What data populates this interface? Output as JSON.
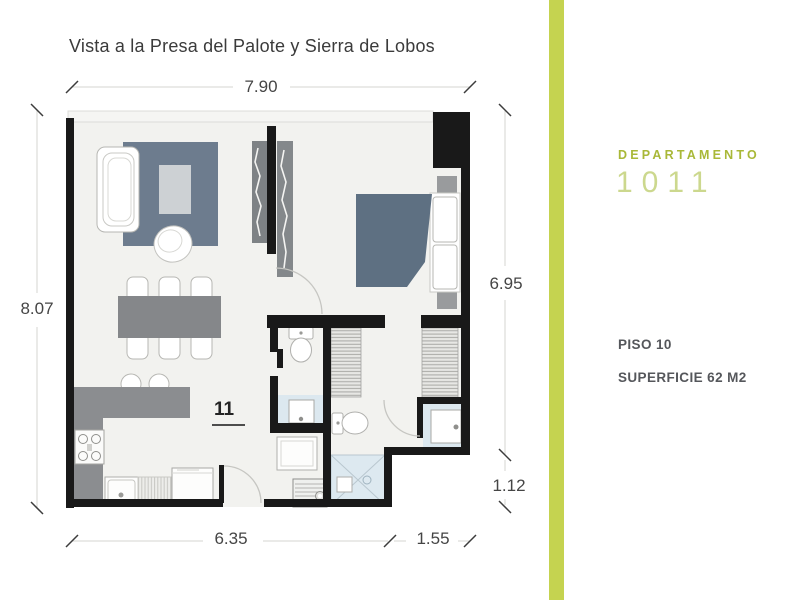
{
  "title": "Vista a la Presa del Palote y Sierra de Lobos",
  "floor_plan": {
    "unit_number": "11",
    "dimensions": {
      "top": "7.90",
      "left": "8.07",
      "right": "6.95",
      "right_lower": "1.12",
      "bottom": "6.35",
      "bottom_right": "1.55"
    }
  },
  "info_panel": {
    "department_label": "DEPARTAMENTO",
    "department_number": "1011",
    "floor_label": "PISO 10",
    "surface_label": "SUPERFICIE 62 M2"
  },
  "colors": {
    "accent_bar": "#c5d350",
    "accent_label": "#a9b838",
    "accent_number": "#ccd88e",
    "wall": "#191919",
    "floor": "#f2f2ef",
    "rug": "#6d7c8e",
    "bed_cover": "#5e7082",
    "furniture_gray": "#87898c",
    "bath_floor": "#dce8ef",
    "title_text": "#3b3b3b",
    "dimension_text": "#454545",
    "panel_text": "#55575b"
  }
}
